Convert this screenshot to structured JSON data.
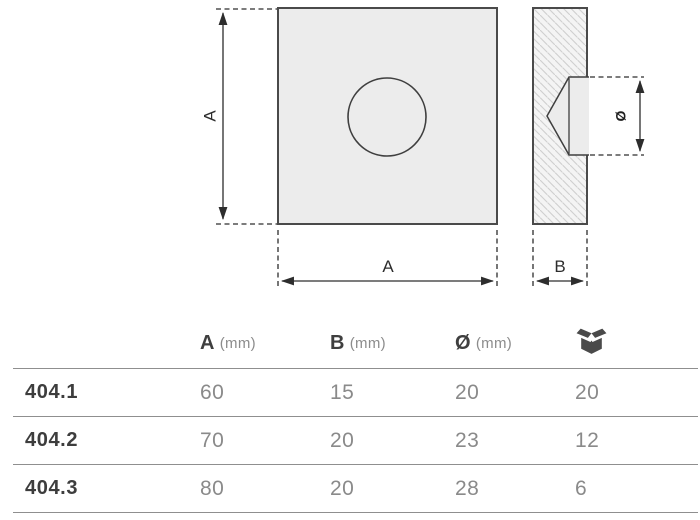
{
  "drawing": {
    "front_view": {
      "height_label": "A",
      "width_label": "A"
    },
    "side_view": {
      "thickness_label": "B",
      "diameter_label": "Ø"
    }
  },
  "table": {
    "header": {
      "col_a_symbol": "A",
      "col_a_unit": "(mm)",
      "col_b_symbol": "B",
      "col_b_unit": "(mm)",
      "col_d_symbol": "Ø",
      "col_d_unit": "(mm)",
      "package_icon": "open-box-icon"
    },
    "rows": [
      {
        "model": "404.1",
        "a_mm": "60",
        "b_mm": "15",
        "diameter_mm": "20",
        "pack_qty": "20"
      },
      {
        "model": "404.2",
        "a_mm": "70",
        "b_mm": "20",
        "diameter_mm": "23",
        "pack_qty": "12"
      },
      {
        "model": "404.3",
        "a_mm": "80",
        "b_mm": "20",
        "diameter_mm": "28",
        "pack_qty": "6"
      }
    ]
  },
  "colors": {
    "text_dark": "#3f3f3f",
    "text_light": "#8a8a8a",
    "table_line": "#8f8f8f",
    "plate_fill": "#ececec",
    "drawing_stroke": "#4a4a4a",
    "hatch_line": "#cfcfcf"
  }
}
